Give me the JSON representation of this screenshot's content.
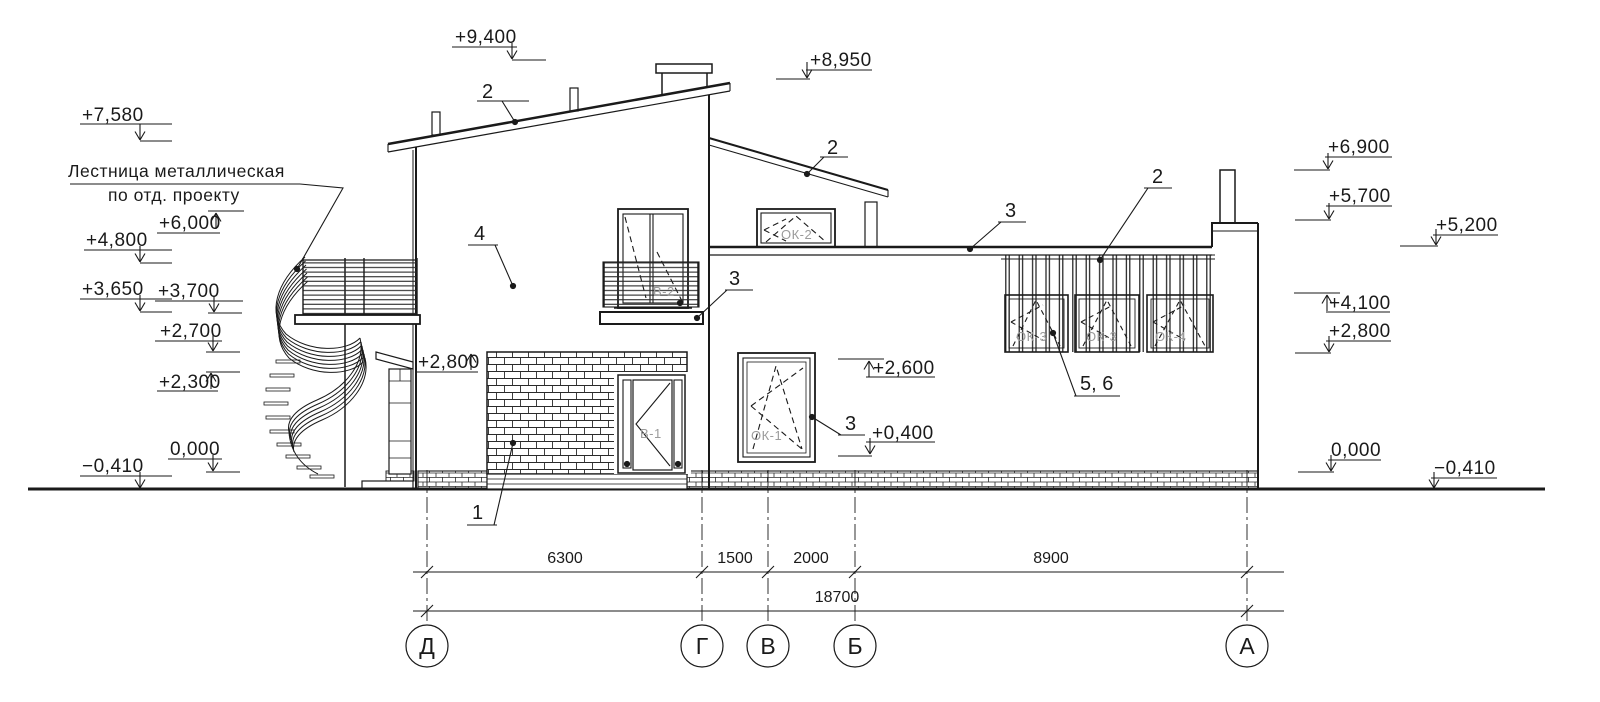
{
  "drawing": {
    "kind": "building facade elevation",
    "note": {
      "line1": "Лестница металлическая",
      "line2": "по отд. проекту"
    },
    "marks": {
      "m7580": "+7,580",
      "m6000": "+6,000",
      "m4800": "+4,800",
      "m3650": "+3,650",
      "m3700": "+3,700",
      "m2700": "+2,700",
      "m2300": "+2,300",
      "m0000_left": "0,000",
      "mneg0410_left": "−0,410",
      "m9400": "+9,400",
      "m8950": "+8,950",
      "m6900": "+6,900",
      "m5700": "+5,700",
      "m5200": "+5,200",
      "m4100": "+4,100",
      "m2800_right": "+2,800",
      "m0000_right": "0,000",
      "mneg0410_right": "−0,410",
      "m2800_facade": "+2,800",
      "m2600": "+2,600",
      "m0400": "+0,400"
    },
    "callouts": {
      "roof_main": "2",
      "roof_low": "2",
      "screen": "2",
      "flat_roof": "3",
      "balcony": "3",
      "window": "3",
      "wall": "4",
      "brick": "1",
      "screen_windows": "5, 6"
    },
    "window_tags": {
      "v2": "В-2",
      "ok2": "ОК-2",
      "v1": "В-1",
      "ok1": "ОК-1",
      "ok3a": "ОК-3",
      "ok3b": "ОК-3",
      "ok4": "ОК-4"
    },
    "dimensions": {
      "span1": "6300",
      "span2": "1500",
      "span3": "2000",
      "span4": "8900",
      "total": "18700"
    },
    "axes": {
      "a1": "Д",
      "a2": "Г",
      "a3": "В",
      "a4": "Б",
      "a5": "А"
    },
    "colors": {
      "line": "#1a1a1a",
      "tag": "#9b9b9b",
      "background": "#ffffff"
    }
  }
}
